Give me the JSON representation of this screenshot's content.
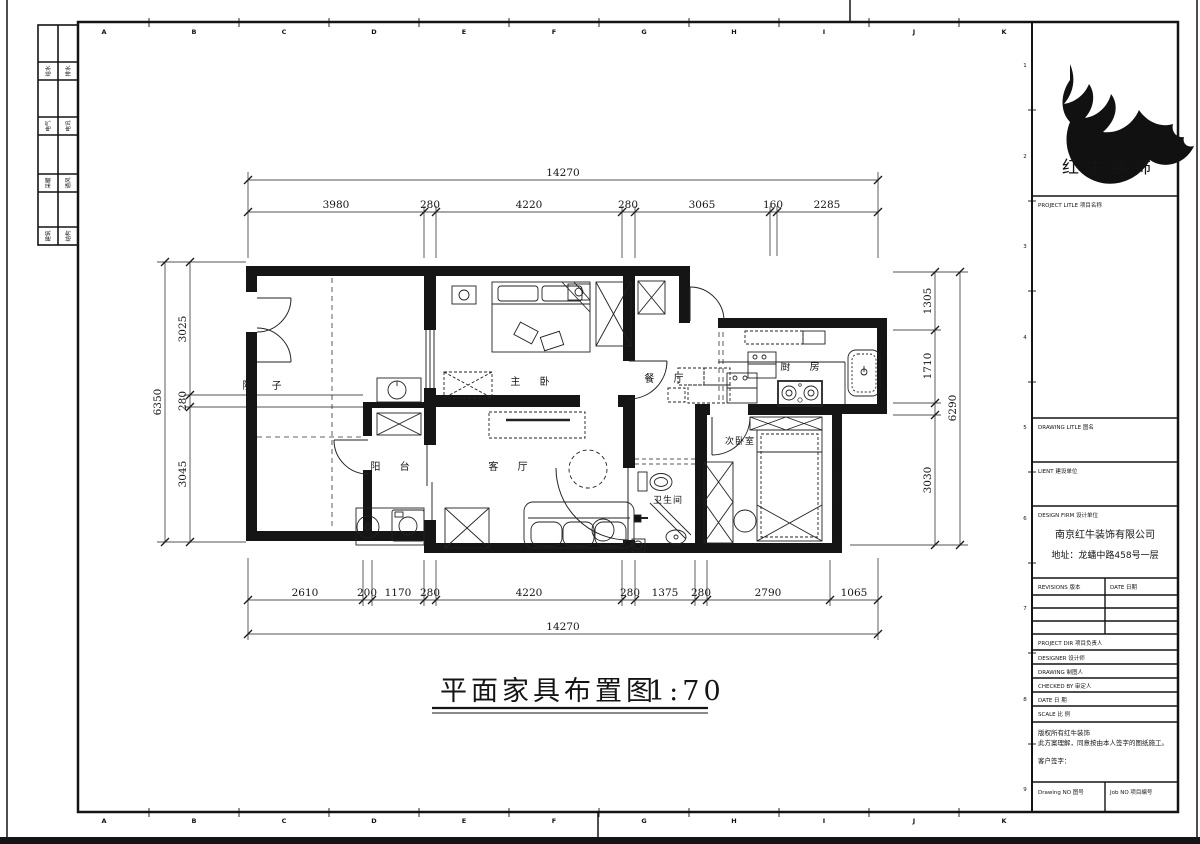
{
  "drawing": {
    "title": "平面家具布置图",
    "scale": "1:70"
  },
  "rooms": {
    "courtyard": "院 子",
    "master_bedroom": "主 卧",
    "dining": "餐 厅",
    "kitchen": "厨 房",
    "balcony": "阳 台",
    "living": "客 厅",
    "bathroom": "卫生间",
    "second_bedroom": "次卧室"
  },
  "dimensions": {
    "top": {
      "overall": "14270",
      "segments": [
        "3980",
        "280",
        "4220",
        "280",
        "3065",
        "160",
        "2285"
      ]
    },
    "bottom": {
      "overall": "14270",
      "segments": [
        "2610",
        "200",
        "1170",
        "280",
        "4220",
        "280",
        "1375",
        "280",
        "2790",
        "1065"
      ]
    },
    "left": {
      "overall": "6350",
      "segments": [
        "3025",
        "280",
        "3045"
      ]
    },
    "right": {
      "overall": "6290",
      "segments": [
        "1305",
        "1710",
        "3030"
      ]
    }
  },
  "grid": {
    "letters": [
      "A",
      "B",
      "C",
      "D",
      "E",
      "F",
      "G",
      "H",
      "I",
      "J",
      "K"
    ],
    "numbers": [
      "1",
      "2",
      "3",
      "4",
      "5",
      "6",
      "7",
      "8",
      "9"
    ]
  },
  "side_tabs": [
    {
      "a": "给水",
      "b": "排水"
    },
    {
      "a": "电气",
      "b": "电讯"
    },
    {
      "a": "采暖",
      "b": "通风"
    },
    {
      "a": "建筑",
      "b": "结构"
    }
  ],
  "title_block": {
    "logo_text": "红牛装饰",
    "project_title_label": "PROJECT LITLE  项目名称",
    "drawing_title_label": "DRAWING LITLE  图名",
    "client_label": "LIENT  建设单位",
    "design_firm_label": "DESIGN FIRM  设计单位",
    "firm_name": "南京红牛装饰有限公司",
    "firm_address": "地址：龙蟠中路458号一层",
    "revisions_label": "REVISIONS  版本",
    "date_col_label": "DATE 日期",
    "project_dir_label": "PROJECT DIR  项目负责人",
    "designer_label": "DESIGNER  设计师",
    "drawing_by_label": "DRAWING  制图人",
    "checked_by_label": "CHECKED BY  审定人",
    "date_label": "DATE  日 期",
    "scale_label": "SCALE  比 例",
    "copyright_line1": "版权所有红牛装饰",
    "copyright_line2": "此方案理解，同意按由本人签字的图纸施工。",
    "client_sign_label": "客户签字：",
    "drawing_no_label": "Drawing NO  图号",
    "job_no_label": "Job NO  项目编号"
  }
}
